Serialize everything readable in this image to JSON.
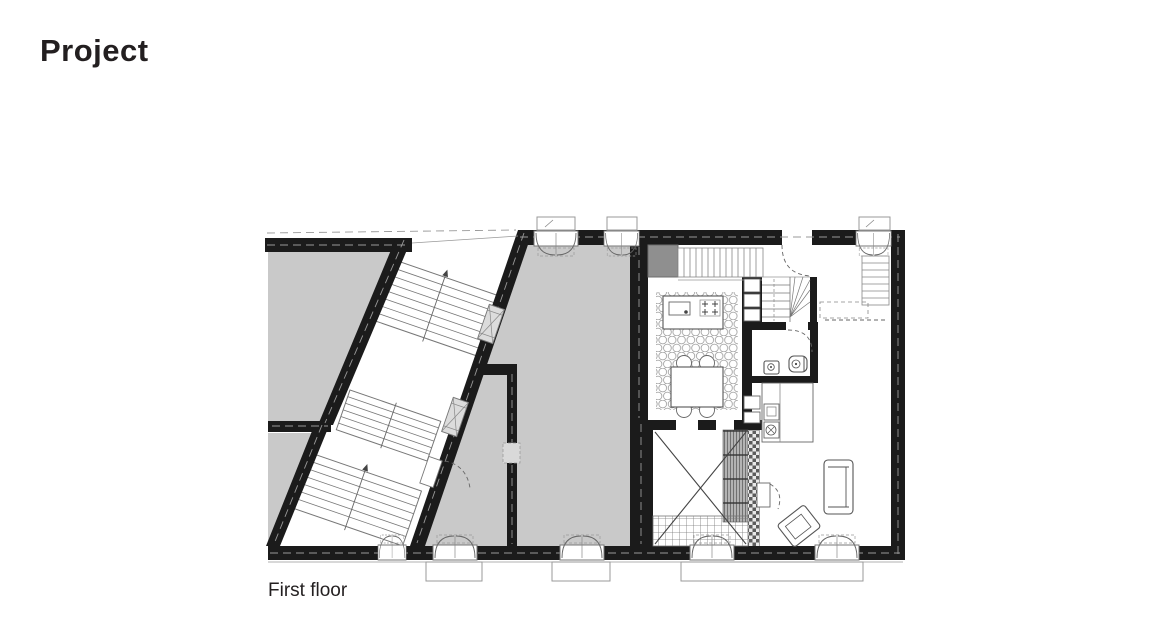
{
  "page": {
    "title": "Project",
    "caption": "First floor"
  },
  "plan": {
    "label": "first-floor-plan",
    "colors": {
      "wall": "#1b1b1b",
      "adjacent_room_fill": "#c9c9c9",
      "shaft_fill": "#8f8f8f",
      "line": "#777777",
      "background": "#ffffff"
    },
    "symbols": [
      "double-run-stairs",
      "winder-stair",
      "entry-stair",
      "side-stair",
      "casement-window",
      "window-sill",
      "door-swing",
      "kitchen-island",
      "cooktop",
      "kitchen-sink",
      "dining-table",
      "chair",
      "scallop-rug",
      "toilet",
      "washbasin",
      "kitchen-counter",
      "void-cross",
      "sofa",
      "armchair",
      "shaft"
    ]
  }
}
